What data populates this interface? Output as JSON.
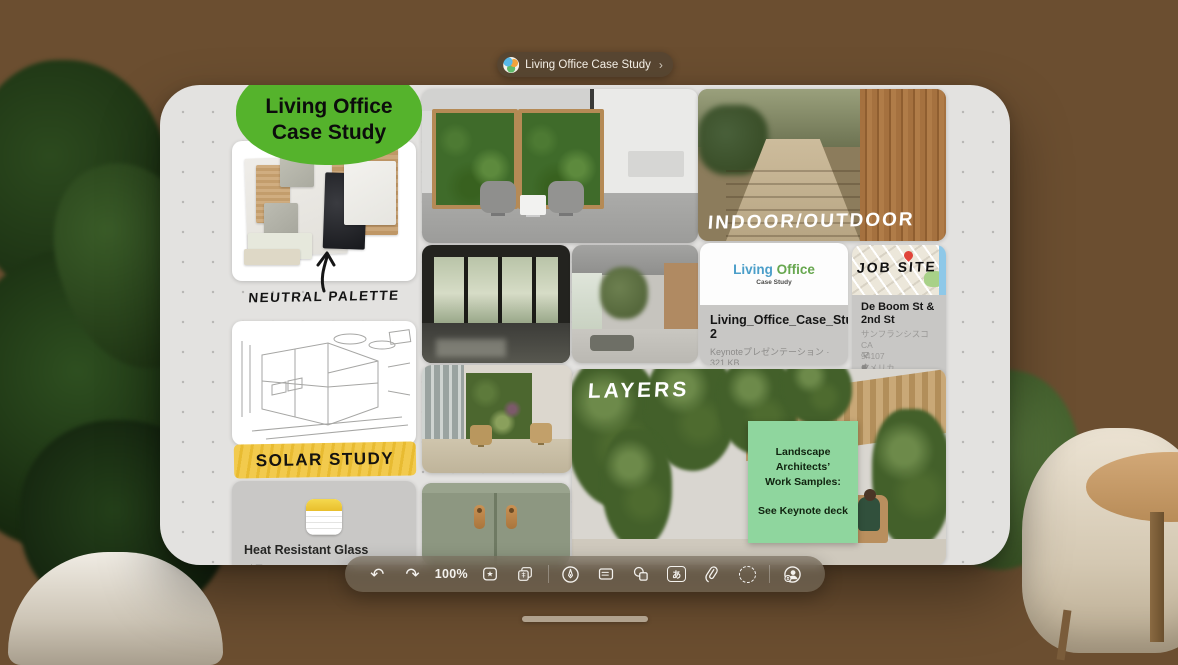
{
  "app": {
    "title_pill": {
      "title": "Living Office Case Study",
      "chevron": "›"
    }
  },
  "board": {
    "badge": {
      "text": "Living Office\nCase Study"
    },
    "palette": {
      "label": "NEUTRAL PALETTE"
    },
    "solar": {
      "label": "SOLAR STUDY"
    },
    "note": {
      "title": "Heat Resistant Glass",
      "subtitle": "メモ"
    },
    "indoor_outdoor": {
      "label": "INDOOR/OUTDOOR"
    },
    "layers": {
      "label": "LAYERS"
    },
    "keynote": {
      "brand_1": "Living",
      "brand_2": "Office",
      "brand_sub": "Case Study",
      "filename": "Living_Office_Case_Study 2",
      "meta": "Keynoteプレゼンテーション · 321 KB"
    },
    "map": {
      "label": "JOB SITE",
      "title": "De Boom St &\n2nd St",
      "address": "サンフランシスコ CA\n94107\nアメリカ",
      "source": "マップ"
    },
    "sticky": {
      "body": "Landscape\nArchitects’\nWork Samples:\n\nSee Keynote deck"
    }
  },
  "toolbar": {
    "zoom_level": "100%",
    "glyphs": {
      "undo": "↶",
      "redo": "↷",
      "text_tool": "あ"
    },
    "icon_names": [
      "undo-icon",
      "redo-icon",
      "zoom-level",
      "insert-widget-icon",
      "duplicate-icon",
      "markup-icon",
      "sticky-note-icon",
      "shapes-icon",
      "text-box-icon",
      "attachment-icon",
      "selection-icon",
      "collaborate-icon"
    ]
  },
  "colors": {
    "badge_green": "#55b32c",
    "sticky_green": "#8fd69e",
    "highlight_yellow": "#f0c84a",
    "keynote_blue": "#4b9ec9",
    "keynote_green": "#67a74f",
    "canvas_gray": "#e3e2e0"
  }
}
